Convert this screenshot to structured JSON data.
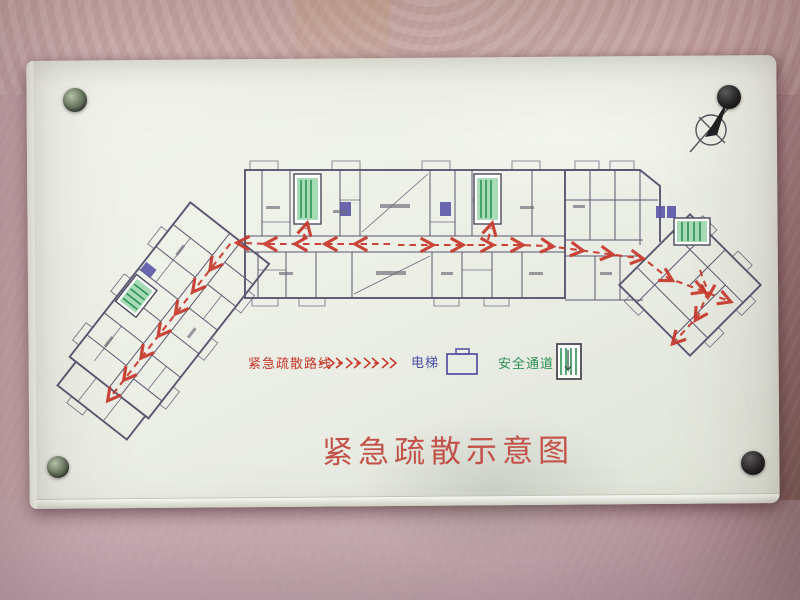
{
  "sign": {
    "title": "紧急疏散示意图",
    "legend": {
      "route": {
        "label": "紧急疏散路线"
      },
      "elevator": {
        "label": "电梯"
      },
      "exit": {
        "label": "安全通道"
      }
    }
  },
  "icons": {
    "north_arrow": "circle-with-cross-and-needle",
    "route_arrow": "red-dashed-double-chevrons",
    "elevator": "purple-rectangle-outline",
    "exit_stairs": "green-stair-bars-in-box",
    "screw_caps": "round-mounting-caps-2-green-2-black"
  },
  "colors": {
    "route_red": "#c8372b",
    "title_red": "#c0463e",
    "elevator_purple": "#5b55a8",
    "elevator_text_blue": "#4a4fae",
    "exit_green": "#2e9157",
    "exit_green_light": "#a8dcb6",
    "plan_line": "#5a5770",
    "panel_face": "#edefe7"
  }
}
